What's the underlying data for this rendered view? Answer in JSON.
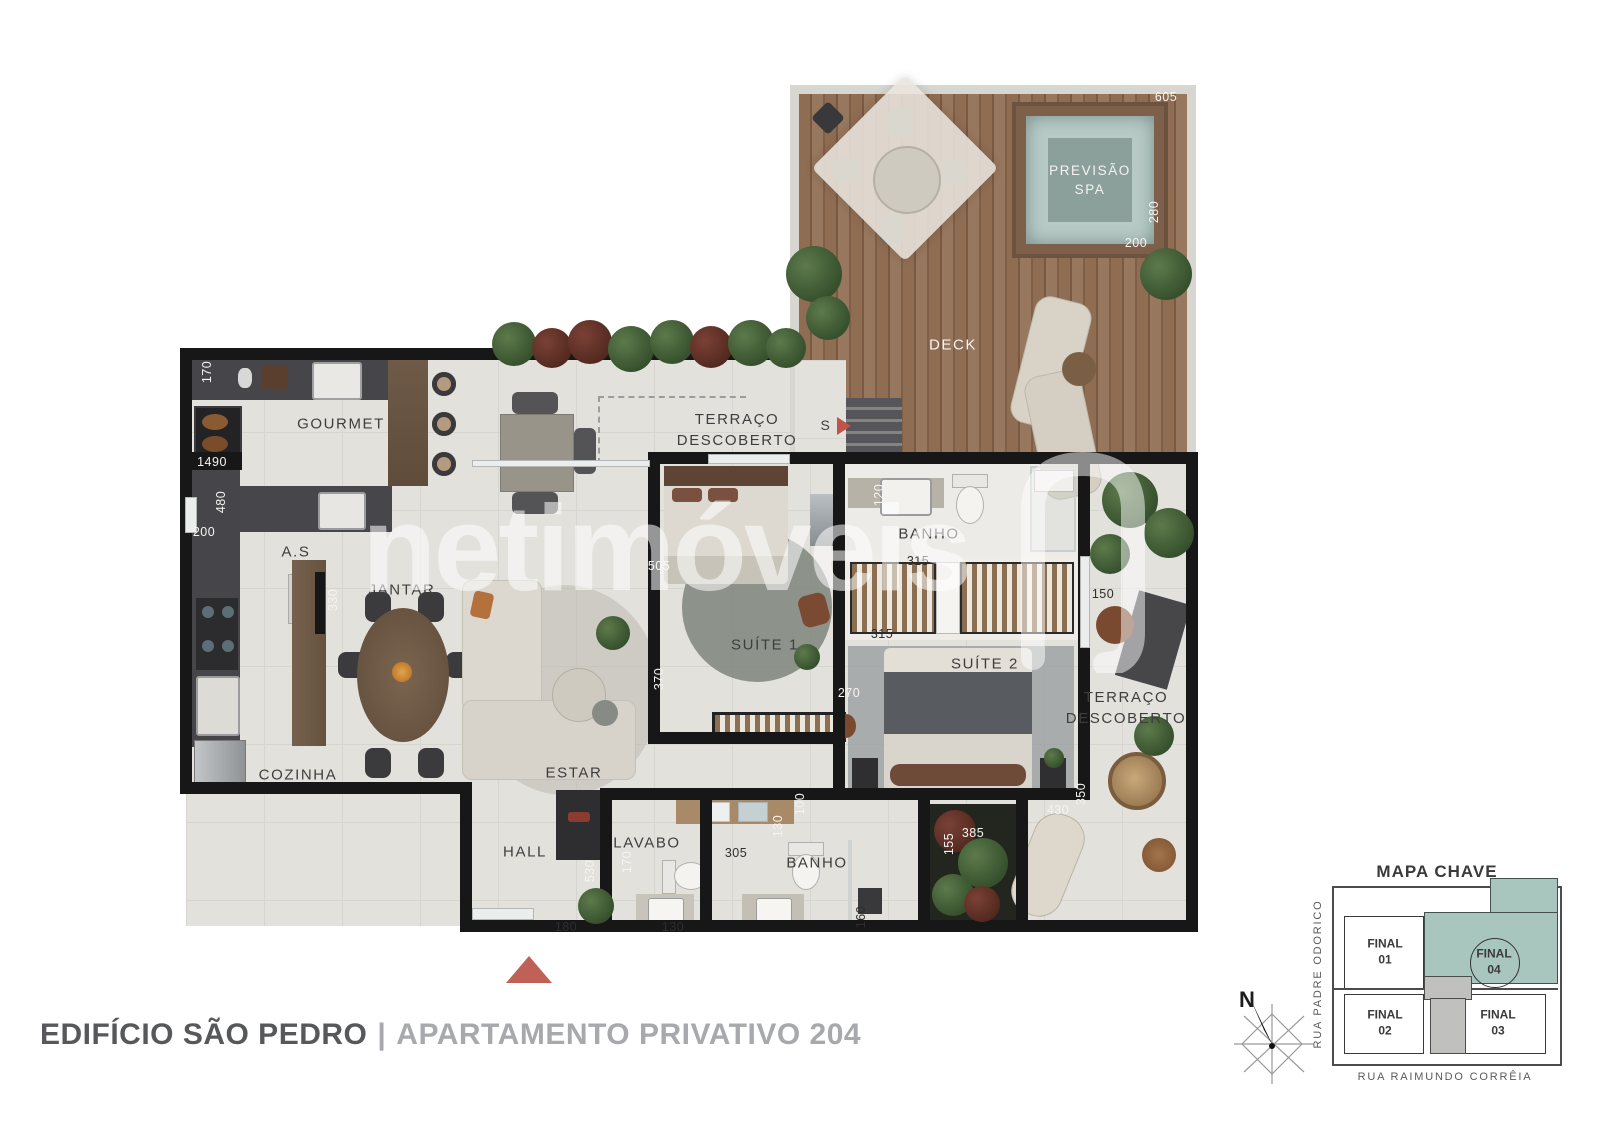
{
  "watermark": {
    "text": "netimóveis"
  },
  "plan": {
    "spa_label": "PREVISÃO\nSPA",
    "entrance_letter": "S",
    "rooms": [
      {
        "id": "gourmet",
        "label": "GOURMET",
        "x": 341,
        "y": 424,
        "light": false
      },
      {
        "id": "terraco-top",
        "label": "TERRAÇO\nDESCOBERTO",
        "x": 737,
        "y": 430,
        "light": false
      },
      {
        "id": "deck",
        "label": "DECK",
        "x": 953,
        "y": 345,
        "light": true
      },
      {
        "id": "as",
        "label": "A.S",
        "x": 296,
        "y": 552,
        "light": false
      },
      {
        "id": "jantar",
        "label": "JANTAR",
        "x": 402,
        "y": 590,
        "light": false
      },
      {
        "id": "cozinha",
        "label": "COZINHA",
        "x": 298,
        "y": 775,
        "light": false
      },
      {
        "id": "estar",
        "label": "ESTAR",
        "x": 574,
        "y": 773,
        "light": false
      },
      {
        "id": "suite1",
        "label": "SUÍTE 1",
        "x": 765,
        "y": 645,
        "light": false
      },
      {
        "id": "banho-suite",
        "label": "BANHO",
        "x": 929,
        "y": 534,
        "light": false
      },
      {
        "id": "suite2",
        "label": "SUÍTE 2",
        "x": 985,
        "y": 664,
        "light": false
      },
      {
        "id": "terraco-right",
        "label": "TERRAÇO\nDESCOBERTO",
        "x": 1126,
        "y": 708,
        "light": false
      },
      {
        "id": "hall",
        "label": "HALL",
        "x": 525,
        "y": 852,
        "light": false
      },
      {
        "id": "lavabo",
        "label": "LAVABO",
        "x": 647,
        "y": 843,
        "light": false
      },
      {
        "id": "banho-social",
        "label": "BANHO",
        "x": 817,
        "y": 863,
        "light": false
      }
    ],
    "dimensions": [
      {
        "v": "605",
        "x": 1166,
        "y": 97,
        "vert": false,
        "light": true
      },
      {
        "v": "280",
        "x": 1154,
        "y": 212,
        "vert": true,
        "light": true
      },
      {
        "v": "200",
        "x": 1136,
        "y": 243,
        "vert": false,
        "light": true
      },
      {
        "v": "170",
        "x": 207,
        "y": 372,
        "vert": true,
        "light": true
      },
      {
        "v": "1490",
        "x": 212,
        "y": 462,
        "vert": false,
        "light": true
      },
      {
        "v": "480",
        "x": 221,
        "y": 502,
        "vert": true,
        "light": true
      },
      {
        "v": "200",
        "x": 204,
        "y": 532,
        "vert": false,
        "light": true
      },
      {
        "v": "330",
        "x": 333,
        "y": 600,
        "vert": true,
        "light": true
      },
      {
        "v": "505",
        "x": 659,
        "y": 566,
        "vert": false,
        "light": true
      },
      {
        "v": "370",
        "x": 659,
        "y": 679,
        "vert": true,
        "light": true
      },
      {
        "v": "270",
        "x": 849,
        "y": 693,
        "vert": false,
        "light": true
      },
      {
        "v": "315",
        "x": 918,
        "y": 561,
        "vert": false,
        "light": false
      },
      {
        "v": "315",
        "x": 882,
        "y": 634,
        "vert": false,
        "light": false
      },
      {
        "v": "120",
        "x": 879,
        "y": 495,
        "vert": true,
        "light": true
      },
      {
        "v": "150",
        "x": 1103,
        "y": 594,
        "vert": false,
        "light": false
      },
      {
        "v": "430",
        "x": 1058,
        "y": 810,
        "vert": false,
        "light": true
      },
      {
        "v": "350",
        "x": 1081,
        "y": 794,
        "vert": true,
        "light": true
      },
      {
        "v": "100",
        "x": 800,
        "y": 804,
        "vert": true,
        "light": true
      },
      {
        "v": "130",
        "x": 778,
        "y": 826,
        "vert": true,
        "light": true
      },
      {
        "v": "155",
        "x": 949,
        "y": 844,
        "vert": true,
        "light": true
      },
      {
        "v": "385",
        "x": 973,
        "y": 833,
        "vert": false,
        "light": true
      },
      {
        "v": "530",
        "x": 590,
        "y": 871,
        "vert": true,
        "light": true
      },
      {
        "v": "170",
        "x": 627,
        "y": 862,
        "vert": true,
        "light": true
      },
      {
        "v": "180",
        "x": 566,
        "y": 927,
        "vert": false,
        "light": false
      },
      {
        "v": "130",
        "x": 673,
        "y": 927,
        "vert": false,
        "light": false
      },
      {
        "v": "305",
        "x": 736,
        "y": 853,
        "vert": false,
        "light": false
      },
      {
        "v": "160",
        "x": 861,
        "y": 917,
        "vert": true,
        "light": false
      }
    ]
  },
  "footer": {
    "building": "EDIFÍCIO SÃO PEDRO",
    "separator": "|",
    "unit": "APARTAMENTO PRIVATIVO 204"
  },
  "key_map": {
    "title": "MAPA CHAVE",
    "units": [
      {
        "label": "FINAL\n01"
      },
      {
        "label": "FINAL\n02"
      },
      {
        "label": "FINAL\n03"
      },
      {
        "label": "FINAL\n04"
      }
    ],
    "street_left": "RUA PADRE ODORICO",
    "street_bottom": "RUA RAIMUNDO CORRÊIA",
    "compass": "N",
    "highlight_color": "#a9c6be",
    "accent_red": "#bf6156"
  }
}
